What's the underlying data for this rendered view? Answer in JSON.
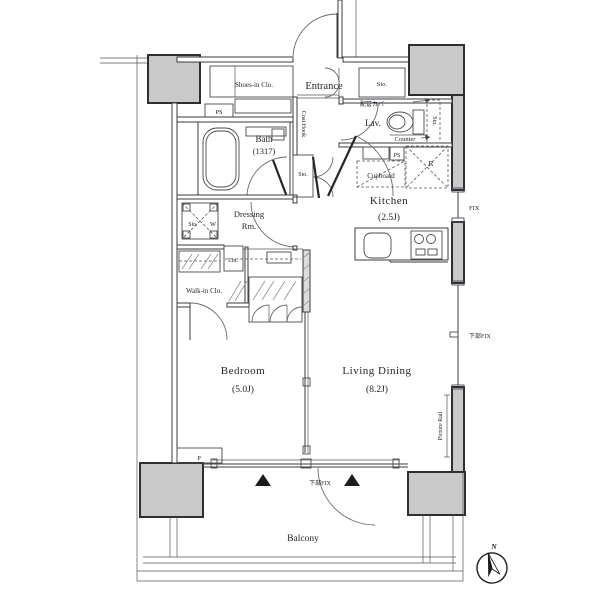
{
  "plan": {
    "rooms": {
      "entrance": "Entrance",
      "shoes_in_clo": "Shoes-in Clo.",
      "sto_entrance": "Sto.",
      "ps_top": "PS",
      "bath": "Bath",
      "bath_size": "(1317)",
      "coat_hook": "Coat Hook",
      "haikan_cover": "配管カバー",
      "lav": "Lav.",
      "sto_lav": "Sto.",
      "counter": "Counter",
      "ps_kitchen": "PS",
      "refrigerator": "R",
      "cupboard": "Cupboard",
      "kitchen": "Kitchen",
      "kitchen_size": "(2.5J)",
      "sto_hall": "Sto.",
      "sto_dressing": "Sto.",
      "washer": "W",
      "dressing_line1": "Dressing",
      "dressing_line2": "Rm.",
      "linen": "Lin.",
      "walk_in_clo": "Walk-in Clo.",
      "bedroom": "Bedroom",
      "bedroom_size": "(5.0J)",
      "living_dining": "Living Dining",
      "living_dining_size": "(8.2J)",
      "pipe": "P",
      "balcony": "Balcony"
    },
    "windows": {
      "fix_right": "FIX",
      "lower_fix_right": "下部FIX",
      "lower_fix_bottom": "下部FIX",
      "picture_rail": "Picture Rail"
    },
    "compass": {
      "north": "N"
    },
    "colors": {
      "background": "#ffffff",
      "wall_fill": "#c9c9c9",
      "line": "#3b3b40",
      "text": "#26262b"
    }
  }
}
